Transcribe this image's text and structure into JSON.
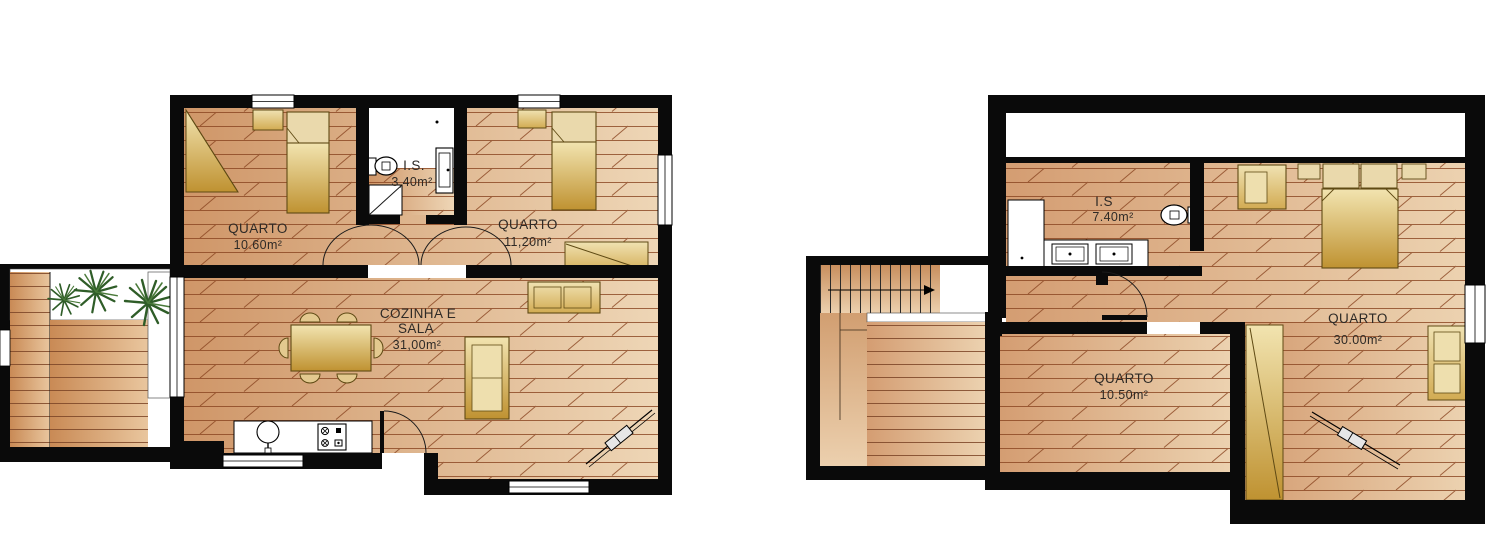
{
  "document": {
    "type": "architectural floor plan",
    "background": "#ffffff"
  },
  "colors": {
    "wall": "#0a0a0a",
    "floor_dark": "#cf9668",
    "floor_light": "#eed6b6",
    "deck_dark": "#c98a55",
    "deck_light": "#e9c69e",
    "hatch_line": "#8a4520",
    "furniture_gold_light": "#f2e4b0",
    "furniture_gold_dark": "#bf9231",
    "pillow_tan": "#ead9ac",
    "plant_green": "#2f5d28",
    "fixture_white": "#ffffff"
  },
  "ground_floor": {
    "rooms": [
      {
        "label": "QUARTO",
        "area": "10.60m²"
      },
      {
        "label": "I.S.",
        "area": "3,40m²"
      },
      {
        "label": "QUARTO",
        "area": "11,20m²"
      },
      {
        "label": "COZINHA E",
        "label2": "SALA",
        "area": "31,00m²"
      }
    ]
  },
  "upper_floor": {
    "rooms": [
      {
        "label": "I.S",
        "area": "7.40m²"
      },
      {
        "label": "QUARTO",
        "area": "30.00m²"
      },
      {
        "label": "QUARTO",
        "area": "10.50m²"
      }
    ]
  }
}
